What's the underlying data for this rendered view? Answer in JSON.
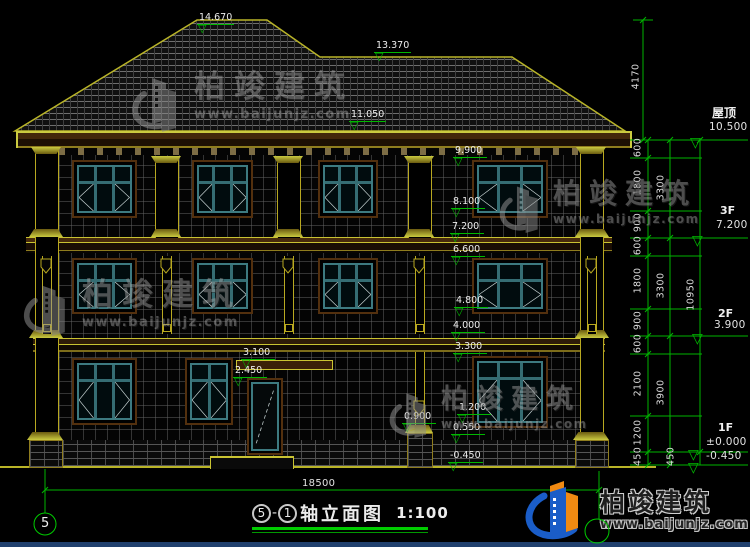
{
  "marks": [
    "14.670",
    "13.370",
    "11.050",
    "9.900",
    "8.100",
    "7.200",
    "6.600",
    "4.800",
    "4.000",
    "3.300",
    "3.100",
    "2.450",
    "1.200",
    "0.900",
    "0.550",
    "-0.450"
  ],
  "levels": {
    "roof_label": "屋顶",
    "roof_value": "10.500",
    "f3_label": "3F",
    "f3_value": "7.200",
    "f2_label": "2F",
    "f2_value": "3.900",
    "f1_label": "1F",
    "f1_value": "±0.000",
    "f1_minus": "-0.450"
  },
  "dims": {
    "roof": "4170",
    "total": "10950",
    "width": "18500",
    "inner": [
      "600",
      "1800",
      "900",
      "600",
      "1800",
      "900",
      "600",
      "2100",
      "1200",
      "450"
    ],
    "mid": [
      "3300",
      "3300",
      "3900",
      "450"
    ]
  },
  "title": {
    "axis_start": "5",
    "separator": "-",
    "axis_end": "1",
    "name": "轴立面图",
    "scale": "1:100"
  },
  "axes": {
    "left": "5",
    "right": ""
  },
  "watermark": {
    "brand": "柏竣建筑",
    "url": "www.baijunjz.com"
  },
  "logo": {
    "brand": "柏竣建筑",
    "url": "www.baijunjz.com"
  },
  "icons": {
    "triangle": "▽"
  },
  "colors": {
    "dimension_green": "#00b800",
    "outline_yellow": "#b9b428",
    "window_teal": "#3d7a80",
    "trim_brown": "#53300e",
    "logo_blue": "#1a5dc8",
    "logo_orange": "#f08a12",
    "watermark_gray": "#9a9a9a",
    "underline_green": "#00cc00"
  }
}
